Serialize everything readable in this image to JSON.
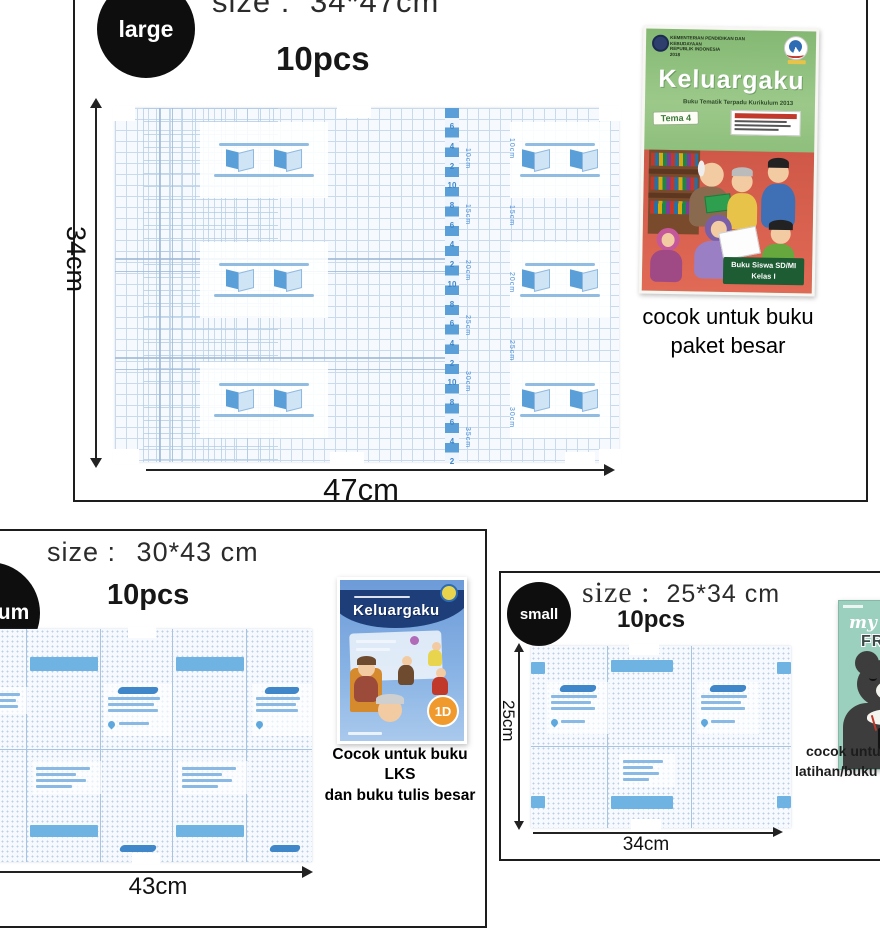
{
  "colors": {
    "frame": "#1d1d1d",
    "badge_bg": "#0e0e0e",
    "sheet_grid": "#c9daed",
    "ruler_blue": "#5b9fd8",
    "bar_blue": "#6fb3e3",
    "caption_text": "#000000",
    "book_large_green": "#8fbf7c",
    "book_large_red": "#cf5848",
    "book_medium_blue": "#6d9bd8",
    "book_small_mint": "#9ad0bd"
  },
  "large": {
    "badge": "large",
    "size_label": "size :",
    "size_value": "34*47cm",
    "qty": "10pcs",
    "height_label": "34cm",
    "width_label": "47cm",
    "ruler_numbers": [
      "6",
      "4",
      "2",
      "10",
      "8",
      "6",
      "4",
      "2",
      "10",
      "8",
      "6",
      "4",
      "2",
      "10",
      "8",
      "6",
      "4",
      "2"
    ],
    "ruler_side_labels": [
      "10cm",
      "15cm",
      "20cm",
      "25cm",
      "30cm",
      "35cm"
    ],
    "ruler_side_labels2": [
      "10cm",
      "15cm",
      "20cm",
      "25cm",
      "30cm"
    ],
    "book": {
      "ministry_line1": "KEMENTERIAN PENDIDIKAN DAN KEBUDAYAAN",
      "ministry_line2": "REPUBLIK INDONESIA",
      "ministry_line3": "2018",
      "title": "Keluargaku",
      "subtitle": "Buku Tematik Terpadu Kurikulum 2013",
      "tema": "Tema 4",
      "footer_line1": "Buku Siswa SD/MI",
      "footer_line2": "Kelas I"
    },
    "caption_line1": "cocok untuk buku",
    "caption_line2": "paket besar"
  },
  "medium": {
    "badge": "medium",
    "size_label": "size :",
    "size_value": "30*43 cm",
    "qty": "10pcs",
    "width_label": "43cm",
    "book": {
      "title": "Keluargaku",
      "badge": "1D"
    },
    "caption_line1": "Cocok untuk buku LKS",
    "caption_line2": "dan buku tulis besar"
  },
  "small": {
    "badge": "small",
    "size_label": "size :",
    "size_value": "25*34 cm",
    "qty": "10pcs",
    "height_label": "25cm",
    "width_label": "34cm",
    "book": {
      "title_script": "my",
      "title_word1": "BEAR",
      "title_word2": "FRIENDS"
    },
    "caption_line1": "cocok untuk buku",
    "caption_line2": "latihan/buku tulis"
  }
}
